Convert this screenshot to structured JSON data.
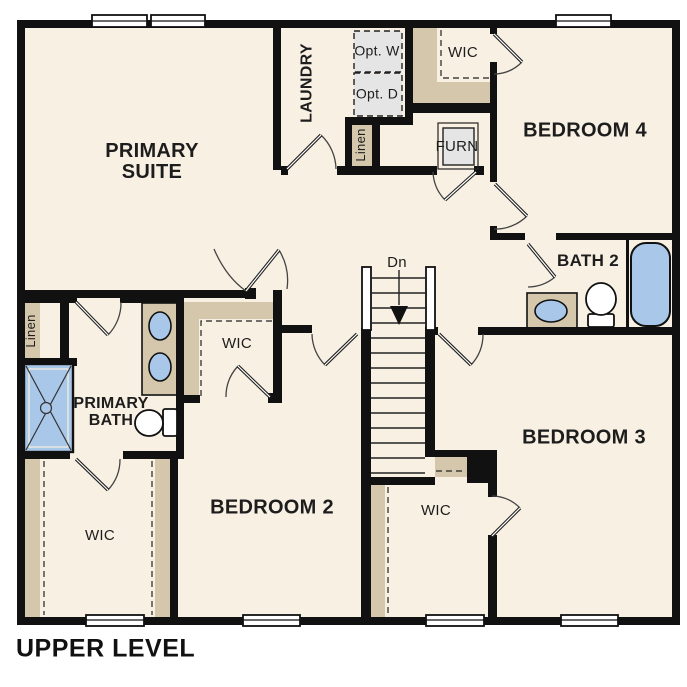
{
  "title": {
    "text": "UPPER LEVEL"
  },
  "rooms": {
    "primary_suite": "PRIMARY SUITE",
    "laundry": "LAUNDRY",
    "opt_washer": "Opt. W",
    "opt_dryer": "Opt. D",
    "linen_upper": "Linen",
    "wic_bedroom4": "WIC",
    "bedroom_4": "BEDROOM 4",
    "furnace": "FURN",
    "bath_2": "BATH 2",
    "stairs_direction": "Dn",
    "bedroom_3": "BEDROOM 3",
    "wic_bedroom3": "WIC",
    "linen_lower": "Linen",
    "primary_bath": "PRIMARY BATH",
    "wic_bedroom2": "WIC",
    "wic_primary": "WIC",
    "bedroom_2": "BEDROOM 2"
  },
  "fixtures": [
    "shower",
    "double-vanity-sinks",
    "toilet",
    "bathtub",
    "vanity-sink",
    "washer-optional",
    "dryer-optional",
    "furnace-unit",
    "staircase-down",
    "window"
  ],
  "colors": {
    "floor": "#f8f0e2",
    "wall": "#111111",
    "shelf_tan": "#d4c7ab",
    "fixture_blue": "#a9c8e9",
    "appliance_gray": "#e5e5e5",
    "text": "#1d1d1d"
  }
}
